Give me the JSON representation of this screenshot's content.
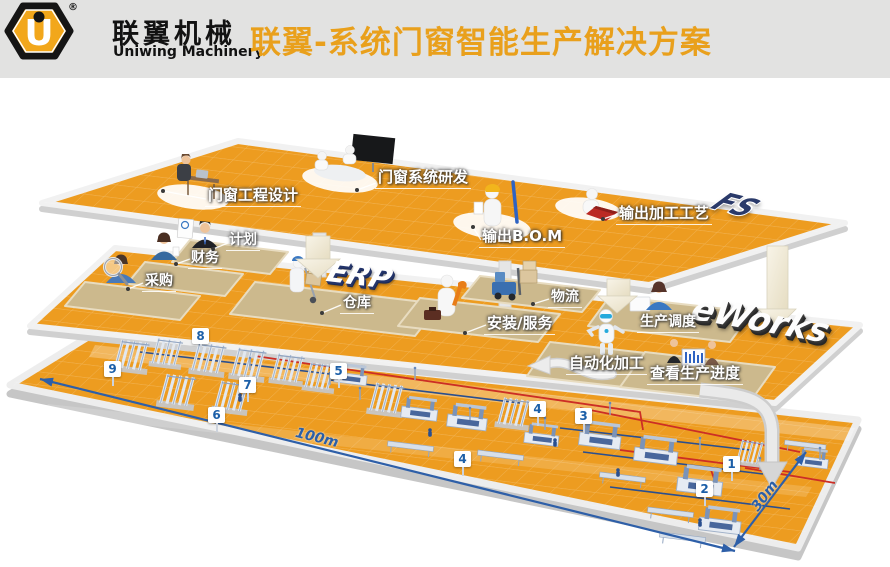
{
  "header": {
    "logo": {
      "mark": "U",
      "registered": "®",
      "brand_cn": "联翼机械",
      "brand_en": "Uniwing Machinery"
    },
    "title": "联翼-系统门窗智能生产解决方案"
  },
  "platforms": {
    "design": {
      "logo3d": "FS",
      "stations": [
        {
          "label": "门窗工程设计"
        },
        {
          "label": "门窗系统研发"
        },
        {
          "label": "输出B.O.M"
        },
        {
          "label": "输出加工工艺"
        }
      ]
    },
    "erp": {
      "logo3d": "ERP",
      "stations": [
        {
          "label": "计划"
        },
        {
          "label": "财务"
        },
        {
          "label": "采购"
        },
        {
          "label": "仓库"
        },
        {
          "label": "物流"
        },
        {
          "label": "安装/服务"
        }
      ]
    },
    "mes": {
      "logo3d": "eWorks",
      "stations": [
        {
          "label": "生产调度"
        },
        {
          "label": "自动化加工"
        },
        {
          "label": "查看生产进度"
        }
      ]
    },
    "factory": {
      "markers": [
        {
          "value": "1"
        },
        {
          "value": "2"
        },
        {
          "value": "3"
        },
        {
          "value": "4"
        },
        {
          "value": "4"
        },
        {
          "value": "5"
        },
        {
          "value": "6"
        },
        {
          "value": "7"
        },
        {
          "value": "8"
        },
        {
          "value": "9"
        }
      ],
      "dimensions": {
        "length": "100m",
        "width": "30m"
      }
    }
  },
  "colors": {
    "floor_orange": "#ed9c20",
    "title_orange": "#e9a01c",
    "marker_blue": "#1c5fa8",
    "path_red": "#cc2e25",
    "dimension_blue": "#2b5fa7",
    "platform_tan": "#ccb98d"
  }
}
